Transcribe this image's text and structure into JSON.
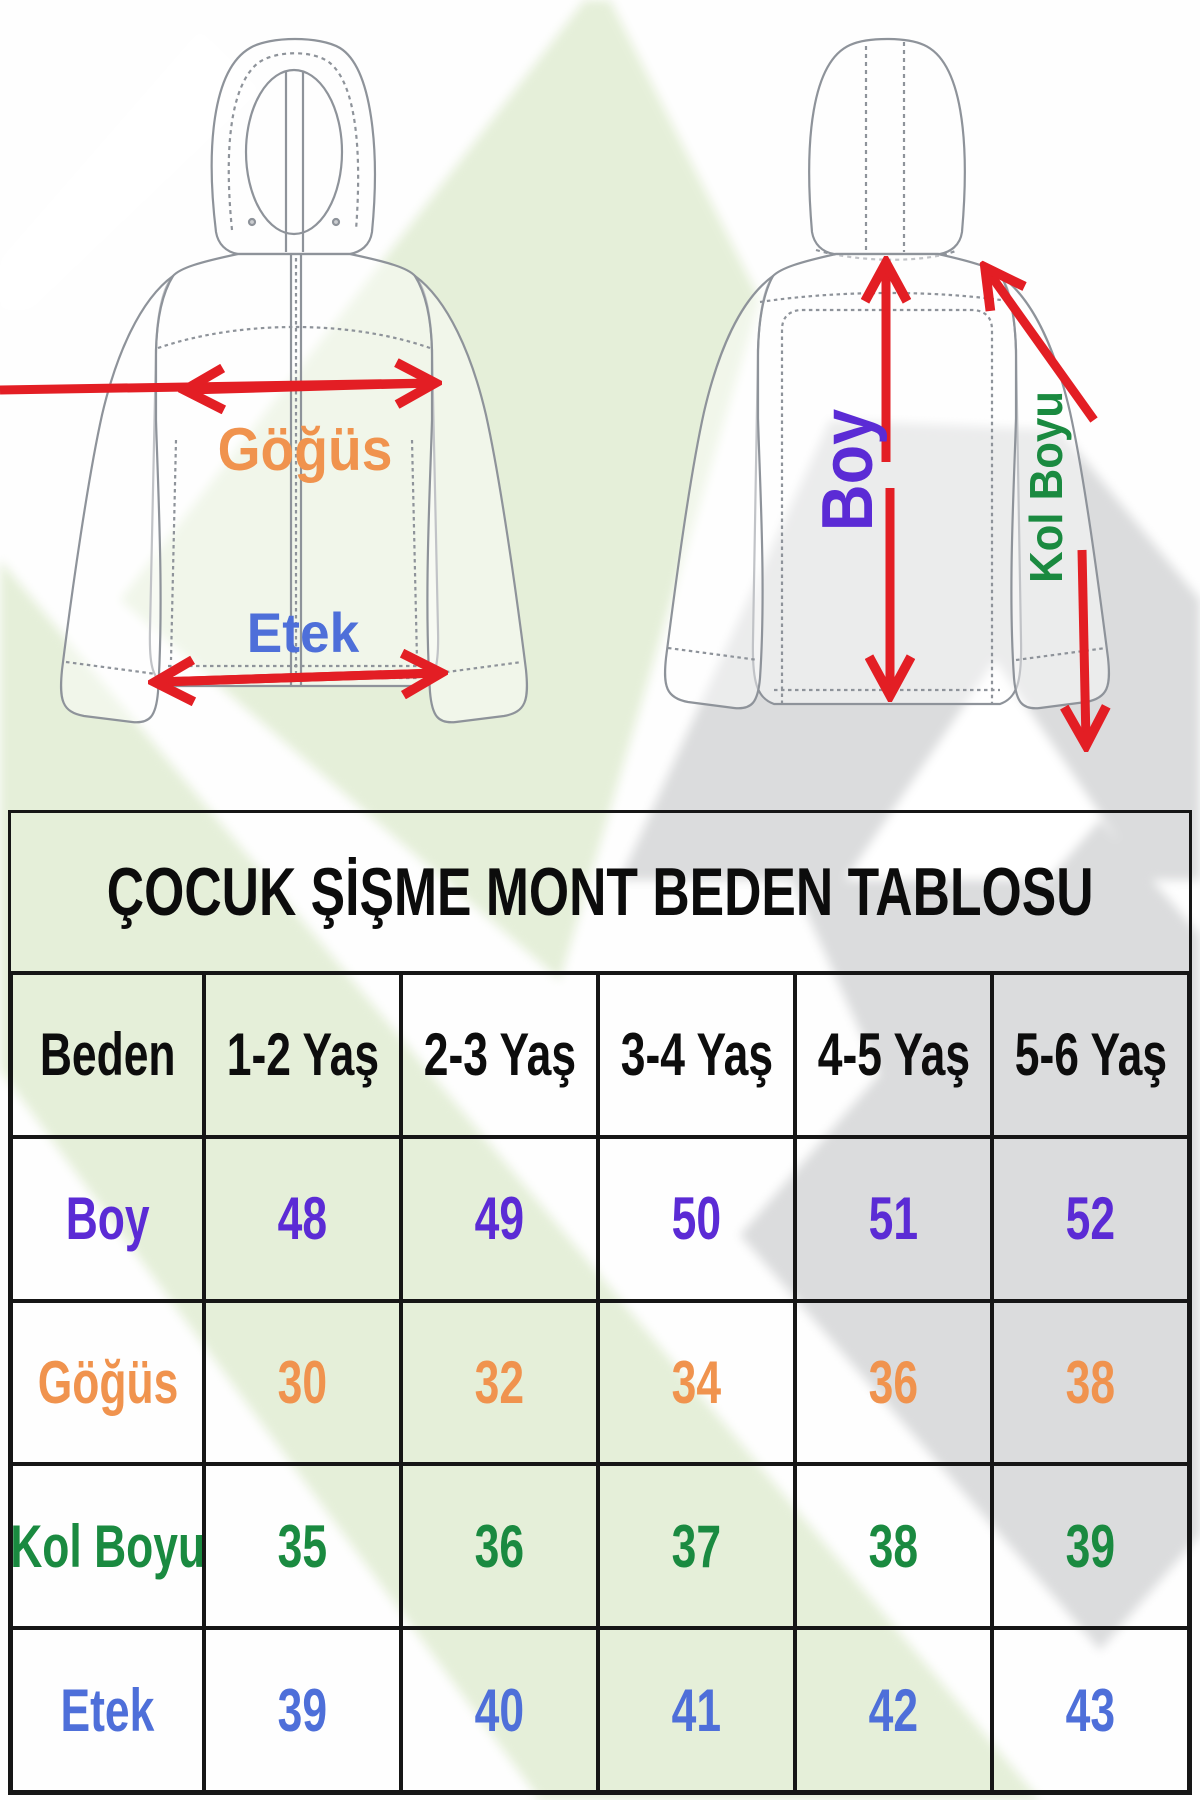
{
  "title": "ÇOCUK ŞİŞME MONT BEDEN TABLOSU",
  "diagram": {
    "front_view": {
      "chest_label": "Göğüs",
      "hem_label": "Etek"
    },
    "back_view": {
      "length_label": "Boy",
      "sleeve_label": "Kol Boyu"
    }
  },
  "colors": {
    "length_boy": "#5B2BD5",
    "chest_gogus": "#F0934E",
    "sleeve_kol_boyu": "#1A8A40",
    "hem_etek": "#4E6FD9",
    "arrow_red": "#E31E24",
    "table_border": "#161616",
    "watermark_green": "#E5EFD9",
    "watermark_gray": "#DBDCDD"
  },
  "chart_data": {
    "type": "table",
    "title": "ÇOCUK ŞİŞME MONT BEDEN TABLOSU",
    "columns": [
      "Beden",
      "1-2 Yaş",
      "2-3 Yaş",
      "3-4 Yaş",
      "4-5 Yaş",
      "5-6 Yaş"
    ],
    "rows": [
      {
        "label": "Boy",
        "color": "#5B2BD5",
        "values": [
          48,
          49,
          50,
          51,
          52
        ]
      },
      {
        "label": "Göğüs",
        "color": "#F0934E",
        "values": [
          30,
          32,
          34,
          36,
          38
        ]
      },
      {
        "label": "Kol Boyu",
        "color": "#1A8A40",
        "values": [
          35,
          36,
          37,
          38,
          39
        ]
      },
      {
        "label": "Etek",
        "color": "#4E6FD9",
        "values": [
          39,
          40,
          41,
          42,
          43
        ]
      }
    ]
  }
}
